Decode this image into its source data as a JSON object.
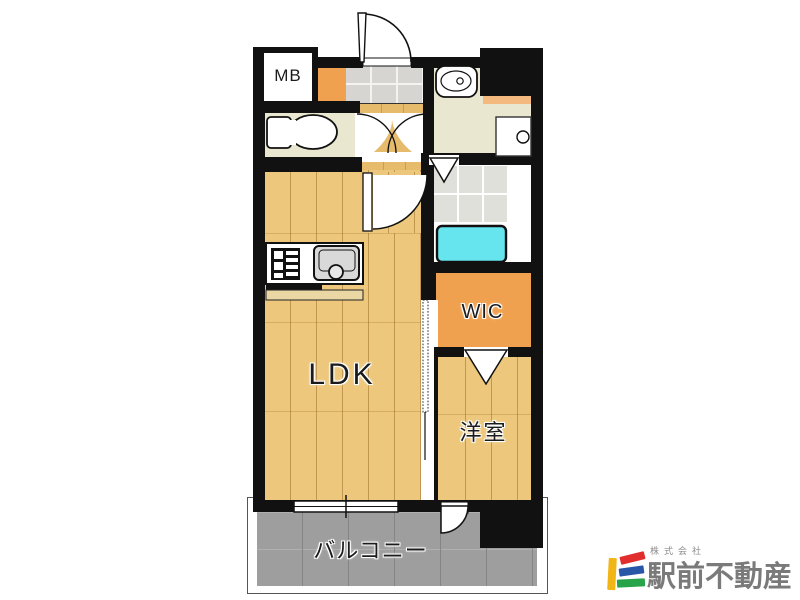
{
  "rooms": {
    "mb": {
      "label": "MB"
    },
    "wic": {
      "label": "WIC"
    },
    "ldk": {
      "label": "LDK"
    },
    "bedroom": {
      "label": "洋室"
    },
    "balcony": {
      "label": "バルコニー"
    }
  },
  "branding": {
    "company_prefix": "株式会社",
    "company_name": "駅前不動産",
    "text_color": "#7a7a7a",
    "logo_colors": {
      "bar_yellow": "#f2b516",
      "bar_red": "#e22d2d",
      "bar_blue": "#2857a8",
      "bar_green": "#27a349"
    }
  },
  "palette": {
    "wall": "#111111",
    "wood_floor": "#edc87c",
    "hall_wood": "#e6bb6c",
    "closet_orange": "#f0a14f",
    "shelf_orange": "#f4b97e",
    "bathtub_cyan": "#67e5ef",
    "balcony_gray": "#9e9e9e",
    "entry_tile_gray": "#d7d5d2",
    "cream_floor": "#eae7d0"
  }
}
